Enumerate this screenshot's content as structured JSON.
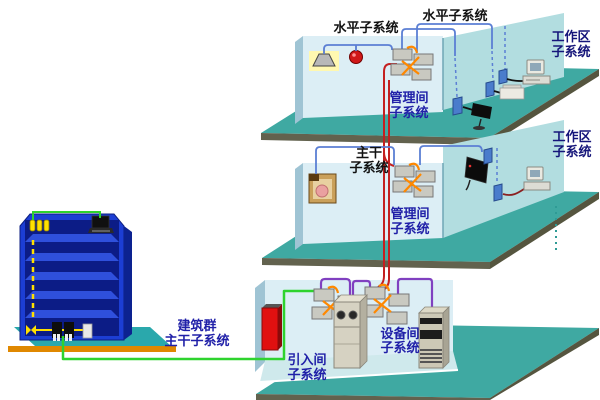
{
  "labels": {
    "horizontal_a": "水平子系统",
    "horizontal_b": "水平子系统",
    "work_area_top": {
      "line1": "工作区",
      "line2": "子系统"
    },
    "management_top": {
      "line1": "管理间",
      "line2": "子系统"
    },
    "backbone": {
      "line1": "主干",
      "line2": "子系统"
    },
    "management_mid": {
      "line1": "管理间",
      "line2": "子系统"
    },
    "work_area_mid": {
      "line1": "工作区",
      "line2": "子系统"
    },
    "campus": {
      "line1": "建筑群",
      "line2": "主干子系统"
    },
    "entrance": {
      "line1": "引入间",
      "line2": "子系统"
    },
    "equipment": {
      "line1": "设备间",
      "line2": "子系统"
    }
  },
  "colors": {
    "floor_slab": "#3FA9A2",
    "slab_edge": "#62624E",
    "room_wall": "#DCEEF5",
    "room_wall_side": "#9FC4D4",
    "tall_wall": "#B2DDE0",
    "room_floor_light": "#CFE9EC",
    "cable_horizontal_blue": "#5B7FD4",
    "cable_backbone_red": "#C42020",
    "cable_campus_green": "#2ED32E",
    "cable_equipment_purple": "#8040C0",
    "cable_cross_orange": "#FF8800",
    "cable_riser_yellow": "#FFE000",
    "building_blue": "#1C3ED4",
    "platform_teal": "#2AA8AC",
    "ground_orange": "#E08800",
    "label_blue": "#2020A8",
    "label_black": "#111111"
  },
  "icons": {
    "ceiling_lamp": "gray trapezoid shade with yellow glow",
    "fire_alarm_bell": "red sphere",
    "patch_panel": "2x2 gray modules with orange cross-connect wires",
    "wall_outlet": "small blue wall plate",
    "surveillance_camera": "black camera on stand",
    "desktop_computer": "monitor on horizontal case",
    "printer": "white box",
    "wall_tv": "black flat panel",
    "wall_speaker": "tan box with round driver",
    "entrance_protector": "red wall-mounted box",
    "pbx_cabinet": "beige cabinet with two round dials",
    "server_rack": "beige tower with dark equipment bays",
    "office_building": "blue multi-storey building on teal platform",
    "laptop": "black laptop"
  }
}
